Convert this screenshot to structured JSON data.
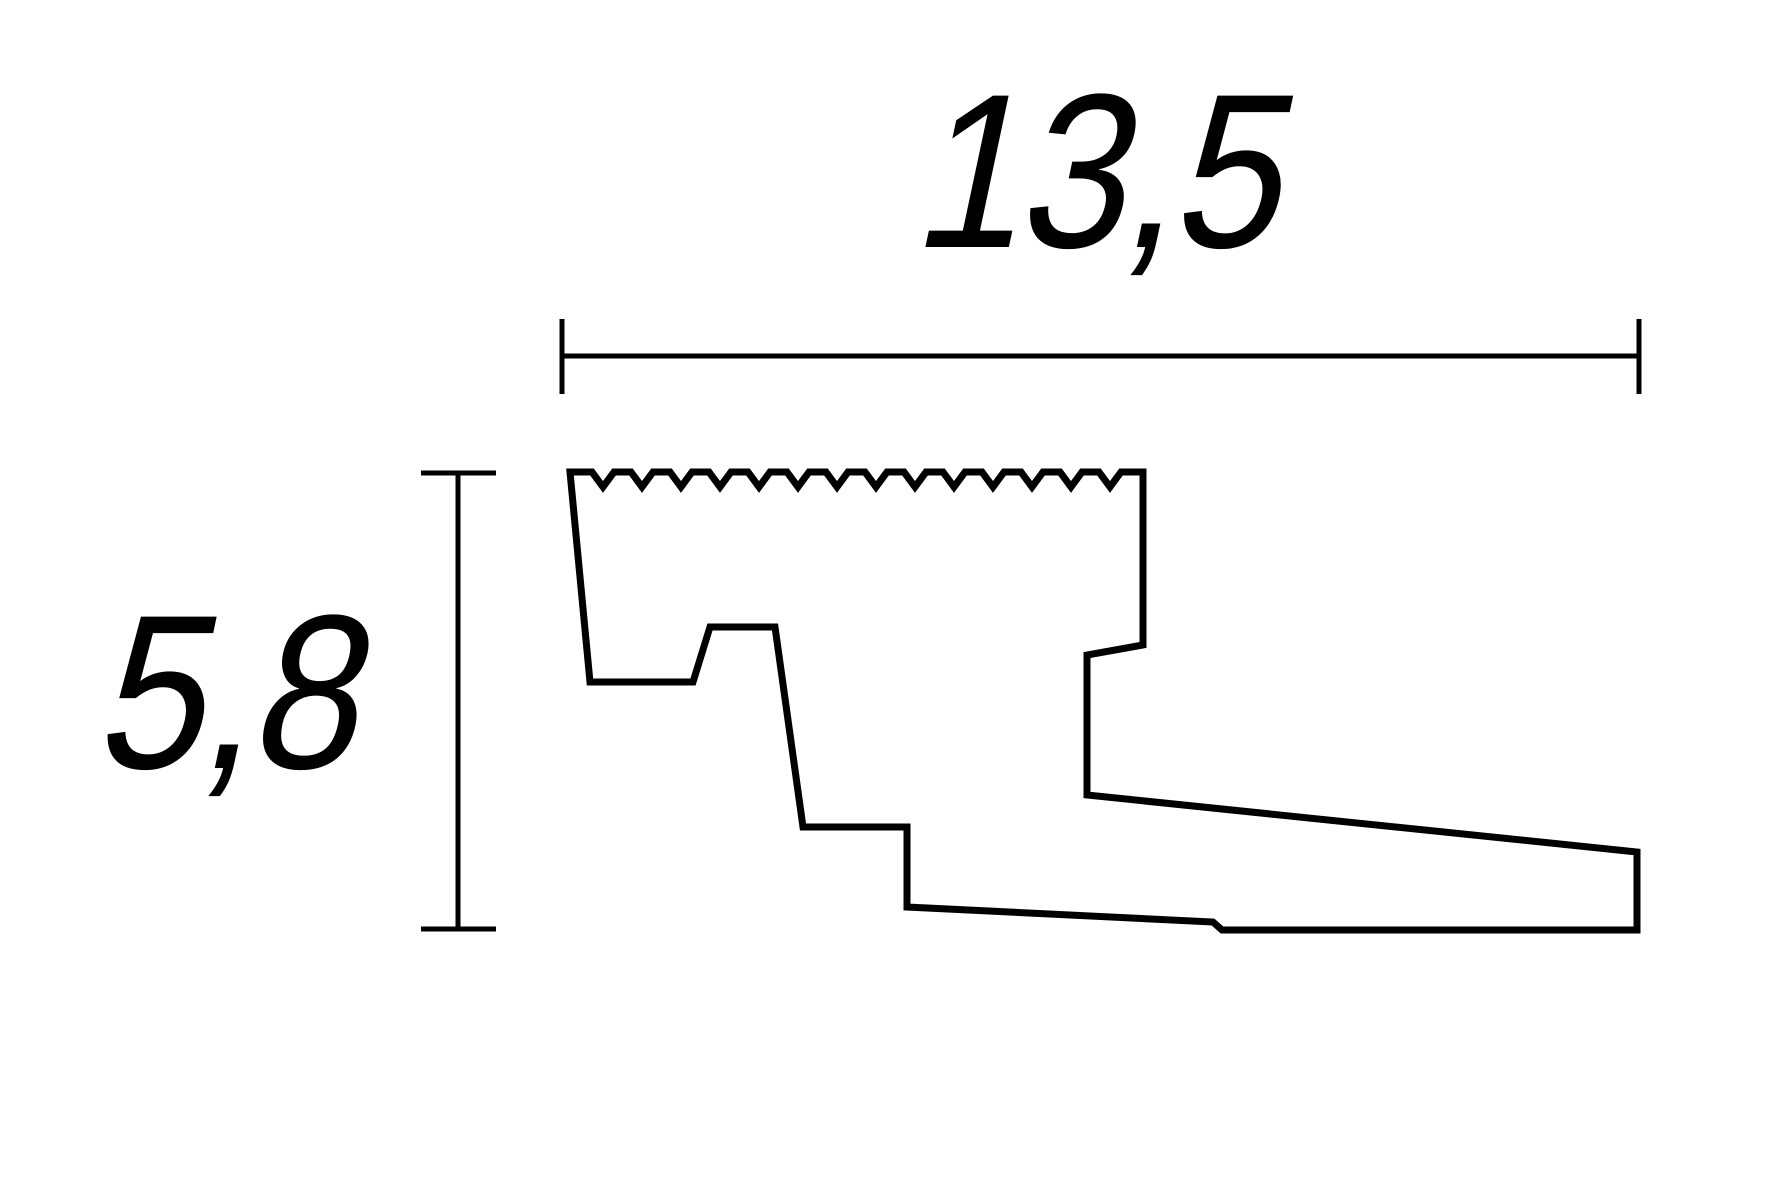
{
  "drawing": {
    "kind": "profile-cross-section-technical-drawing",
    "width_dimension": {
      "label": "13,5"
    },
    "height_dimension": {
      "label": "5,8"
    }
  },
  "colors": {
    "line": "#000000",
    "background": "#ffffff"
  }
}
